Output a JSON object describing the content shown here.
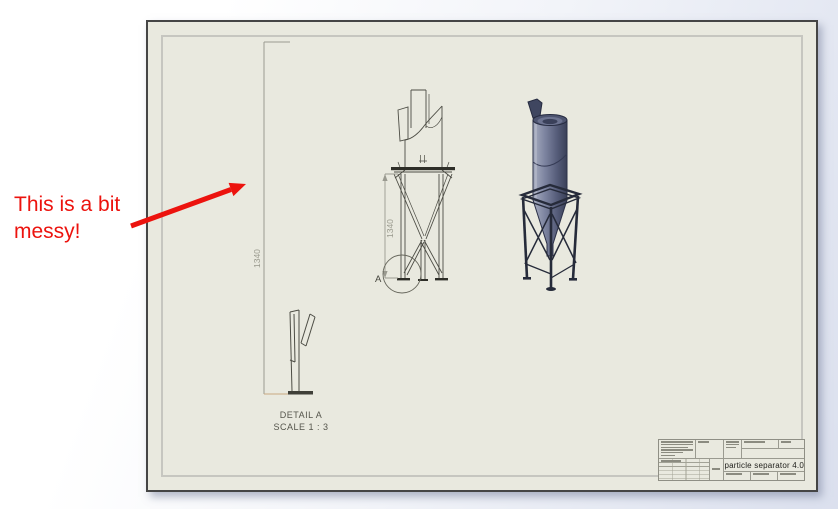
{
  "annotation": {
    "line1": "This is a bit",
    "line2": "messy!",
    "color": "#ec130e"
  },
  "sheet": {
    "background_color": "#e9e9df",
    "left_dimension": {
      "value": "1340"
    },
    "front_view": {
      "dimension": "1340",
      "detail_marker": "A"
    },
    "detail_view": {
      "title": "DETAIL A",
      "scale": "SCALE 1 : 3"
    },
    "title_block": {
      "drawing_title": "particle separator 4.0"
    }
  },
  "colors": {
    "line": "#4d4d45",
    "dimension_line": "#9a9a90",
    "extension_tan": "#c9a982",
    "iso_body": "#6b7390",
    "iso_frame": "#262b3a"
  }
}
